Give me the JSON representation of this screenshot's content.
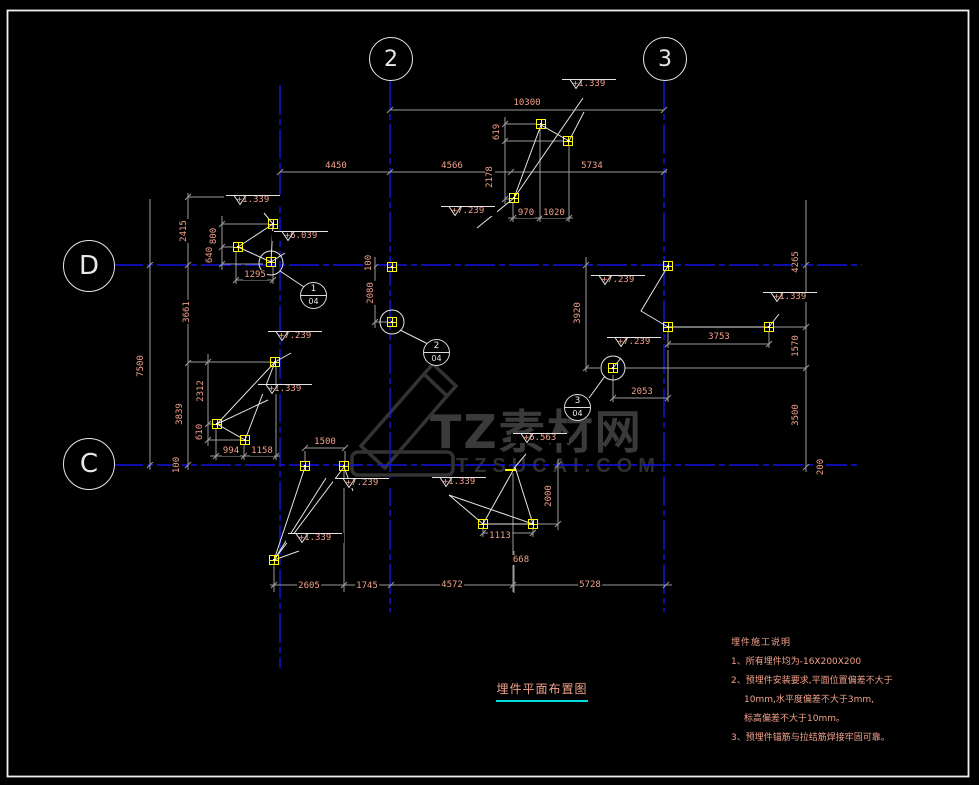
{
  "title": {
    "text": "埋件平面布置图"
  },
  "watermark": {
    "logo_text": "TZ素材网",
    "url_text": "TZSUCAI.COM"
  },
  "notes": {
    "heading": "埋件施工说明",
    "items": [
      {
        "text": "1、所有埋件均为-16X200X200",
        "indent": 0
      },
      {
        "text": "2、预埋件安装要求,平面位置偏差不大于",
        "indent": 0
      },
      {
        "text": "10mm,水平度偏差不大于3mm,",
        "indent": 1
      },
      {
        "text": "标高偏差不大于10mm。",
        "indent": 1
      },
      {
        "text": "3、预埋件锚筋与拉结筋焊接牢固可靠。",
        "indent": 0
      }
    ]
  },
  "grid_bubbles": [
    {
      "label": "2",
      "x": 390,
      "y": 58,
      "r": 21
    },
    {
      "label": "3",
      "x": 664,
      "y": 58,
      "r": 21
    },
    {
      "label": "D",
      "x": 88,
      "y": 265,
      "r": 25
    },
    {
      "label": "C",
      "x": 88,
      "y": 463,
      "r": 25
    }
  ],
  "dimensions": [
    {
      "text": "10300",
      "x": 527,
      "y": 103
    },
    {
      "text": "4450",
      "x": 336,
      "y": 166
    },
    {
      "text": "4566",
      "x": 452,
      "y": 166
    },
    {
      "text": "5734",
      "x": 592,
      "y": 166
    },
    {
      "text": "619",
      "x": 497,
      "y": 132,
      "v": true
    },
    {
      "text": "2178",
      "x": 490,
      "y": 177,
      "v": true
    },
    {
      "text": "970",
      "x": 526,
      "y": 213
    },
    {
      "text": "1020",
      "x": 554,
      "y": 213
    },
    {
      "text": "2415",
      "x": 184,
      "y": 231,
      "v": true
    },
    {
      "text": "3661",
      "x": 187,
      "y": 312,
      "v": true
    },
    {
      "text": "3839",
      "x": 180,
      "y": 414,
      "v": true
    },
    {
      "text": "7500",
      "x": 141,
      "y": 366,
      "v": true
    },
    {
      "text": "800",
      "x": 214,
      "y": 236,
      "v": true
    },
    {
      "text": "640",
      "x": 210,
      "y": 255,
      "v": true
    },
    {
      "text": "1295",
      "x": 255,
      "y": 275
    },
    {
      "text": "100",
      "x": 369,
      "y": 263,
      "v": true
    },
    {
      "text": "2080",
      "x": 371,
      "y": 293,
      "v": true
    },
    {
      "text": "3920",
      "x": 578,
      "y": 313,
      "v": true
    },
    {
      "text": "4265",
      "x": 796,
      "y": 262,
      "v": true
    },
    {
      "text": "1570",
      "x": 796,
      "y": 346,
      "v": true
    },
    {
      "text": "3500",
      "x": 796,
      "y": 415,
      "v": true
    },
    {
      "text": "200",
      "x": 821,
      "y": 467,
      "v": true
    },
    {
      "text": "3753",
      "x": 719,
      "y": 337
    },
    {
      "text": "2053",
      "x": 642,
      "y": 392
    },
    {
      "text": "2312",
      "x": 201,
      "y": 391,
      "v": true
    },
    {
      "text": "610",
      "x": 200,
      "y": 432,
      "v": true
    },
    {
      "text": "994",
      "x": 231,
      "y": 451
    },
    {
      "text": "1158",
      "x": 262,
      "y": 451
    },
    {
      "text": "1500",
      "x": 325,
      "y": 442
    },
    {
      "text": "100",
      "x": 177,
      "y": 465,
      "v": true
    },
    {
      "text": "2000",
      "x": 549,
      "y": 496,
      "v": true
    },
    {
      "text": "1113",
      "x": 500,
      "y": 536
    },
    {
      "text": "668",
      "x": 521,
      "y": 560
    },
    {
      "text": "2605",
      "x": 309,
      "y": 586
    },
    {
      "text": "1745",
      "x": 367,
      "y": 586
    },
    {
      "text": "4572",
      "x": 452,
      "y": 585
    },
    {
      "text": "5728",
      "x": 590,
      "y": 585
    }
  ],
  "elevations": [
    {
      "text": "+1.339",
      "x": 589,
      "y": 85
    },
    {
      "text": "+1.339",
      "x": 253,
      "y": 201
    },
    {
      "text": "+6.039",
      "x": 301,
      "y": 237
    },
    {
      "text": "+7.239",
      "x": 468,
      "y": 212
    },
    {
      "text": "+7.239",
      "x": 295,
      "y": 337
    },
    {
      "text": "+1.339",
      "x": 285,
      "y": 390
    },
    {
      "text": "+7.239",
      "x": 618,
      "y": 281
    },
    {
      "text": "+1.339",
      "x": 790,
      "y": 298
    },
    {
      "text": "+7.239",
      "x": 634,
      "y": 343
    },
    {
      "text": "+7.239",
      "x": 362,
      "y": 484
    },
    {
      "text": "+1.339",
      "x": 459,
      "y": 483
    },
    {
      "text": "+6.563",
      "x": 540,
      "y": 439
    },
    {
      "text": "+1.339",
      "x": 315,
      "y": 539
    }
  ],
  "callouts": [
    {
      "detail": "1",
      "sheet": "04",
      "x": 313,
      "y": 295
    },
    {
      "detail": "2",
      "sheet": "04",
      "x": 436,
      "y": 352
    },
    {
      "detail": "3",
      "sheet": "04",
      "x": 577,
      "y": 407
    }
  ],
  "plates": [
    [
      273,
      224
    ],
    [
      238,
      247
    ],
    [
      271,
      262
    ],
    [
      541,
      124
    ],
    [
      568,
      141
    ],
    [
      514,
      198
    ],
    [
      392,
      267
    ],
    [
      392,
      322
    ],
    [
      668,
      266
    ],
    [
      668,
      327
    ],
    [
      769,
      327
    ],
    [
      613,
      368
    ],
    [
      275,
      362
    ],
    [
      217,
      424
    ],
    [
      245,
      440
    ],
    [
      305,
      466
    ],
    [
      344,
      466
    ],
    [
      483,
      524
    ],
    [
      533,
      524
    ],
    [
      274,
      560
    ]
  ],
  "colors": {
    "background": "#000000",
    "grid_line": "#1414e8",
    "dimension_line": "#9a9a9a",
    "dimension_text": "#f2a08a",
    "geometry": "#e6e6e6",
    "plate": "#ffff00",
    "title_underline": "#00dcdc",
    "watermark": "#3a3a3a"
  }
}
